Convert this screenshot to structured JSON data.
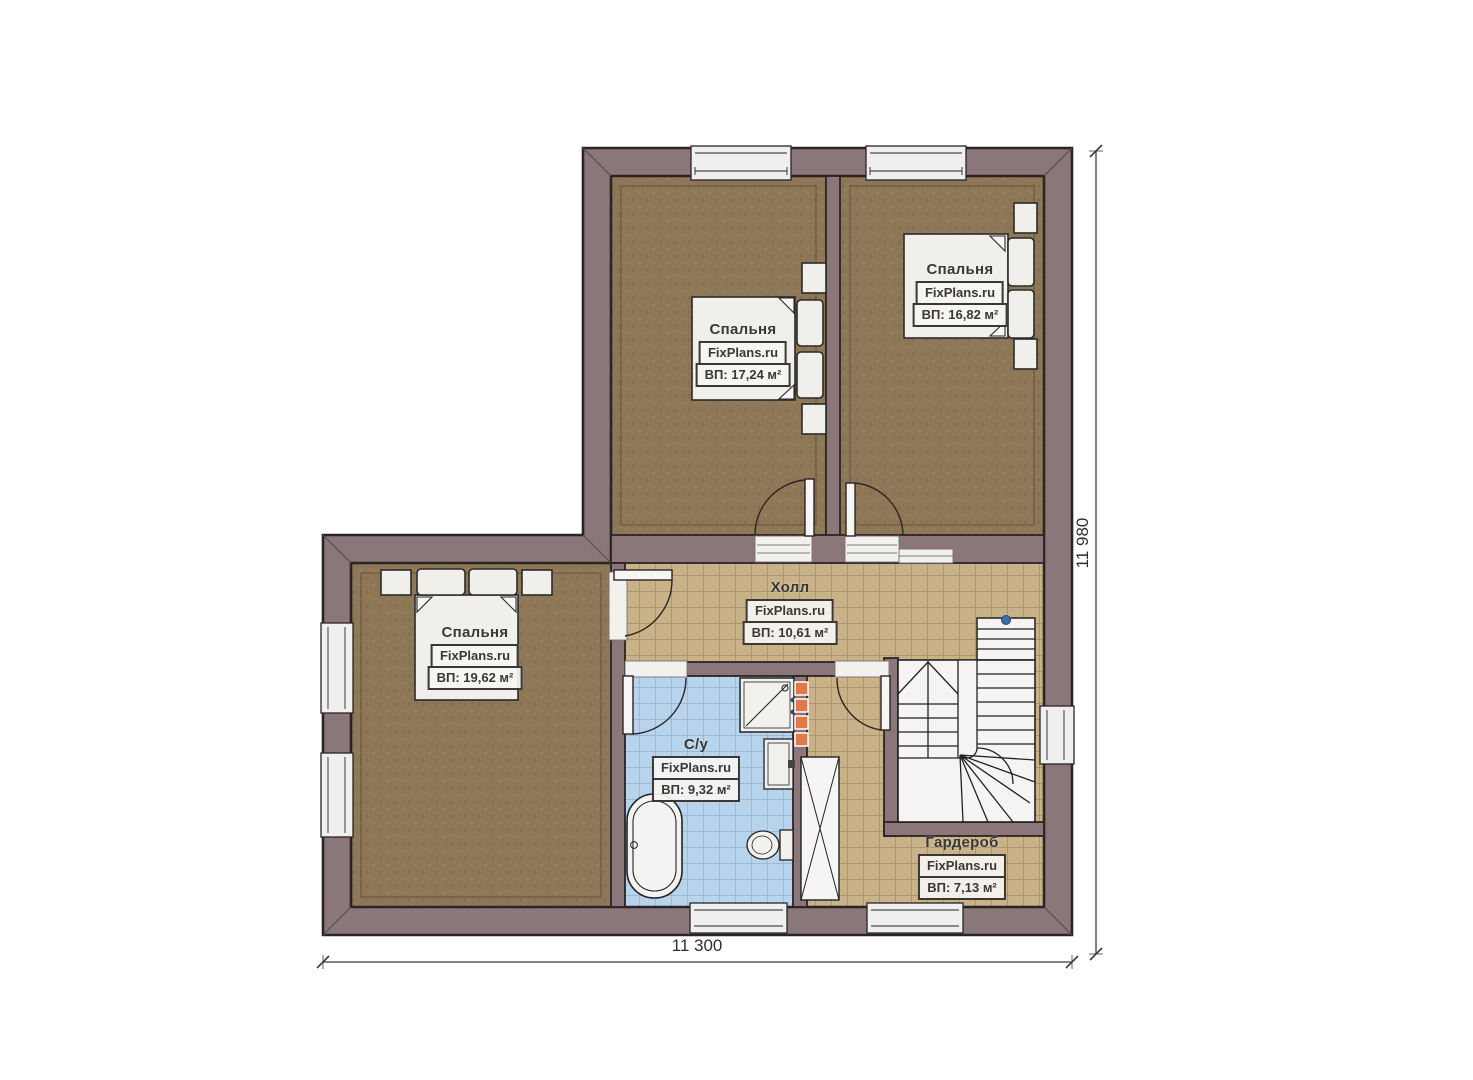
{
  "rooms": [
    {
      "id": "bedroom-top-left",
      "name": "Спальня",
      "site": "FixPlans.ru",
      "area": "ВП: 17,24 м²"
    },
    {
      "id": "bedroom-top-right",
      "name": "Спальня",
      "site": "FixPlans.ru",
      "area": "ВП: 16,82 м²"
    },
    {
      "id": "bedroom-lower-left",
      "name": "Спальня",
      "site": "FixPlans.ru",
      "area": "ВП: 19,62 м²"
    },
    {
      "id": "hall",
      "name": "Холл",
      "site": "FixPlans.ru",
      "area": "ВП: 10,61 м²"
    },
    {
      "id": "bathroom",
      "name": "С/у",
      "site": "FixPlans.ru",
      "area": "ВП: 9,32 м²"
    },
    {
      "id": "wardrobe",
      "name": "Гардероб",
      "site": "FixPlans.ru",
      "area": "ВП: 7,13 м²"
    }
  ],
  "dimensions": {
    "width_label": "11 300",
    "height_label": "11 980"
  },
  "colors": {
    "wall": "#8b767a",
    "bedroom_floor": "#8d7757",
    "hall_tile": "#c9b287",
    "bath_tile": "#b8d4ed",
    "fixture_fill": "#f2f1ee",
    "towel_rail": "#e0784a",
    "stair_marker": "#3a6ea5",
    "outline": "#2b2424"
  }
}
